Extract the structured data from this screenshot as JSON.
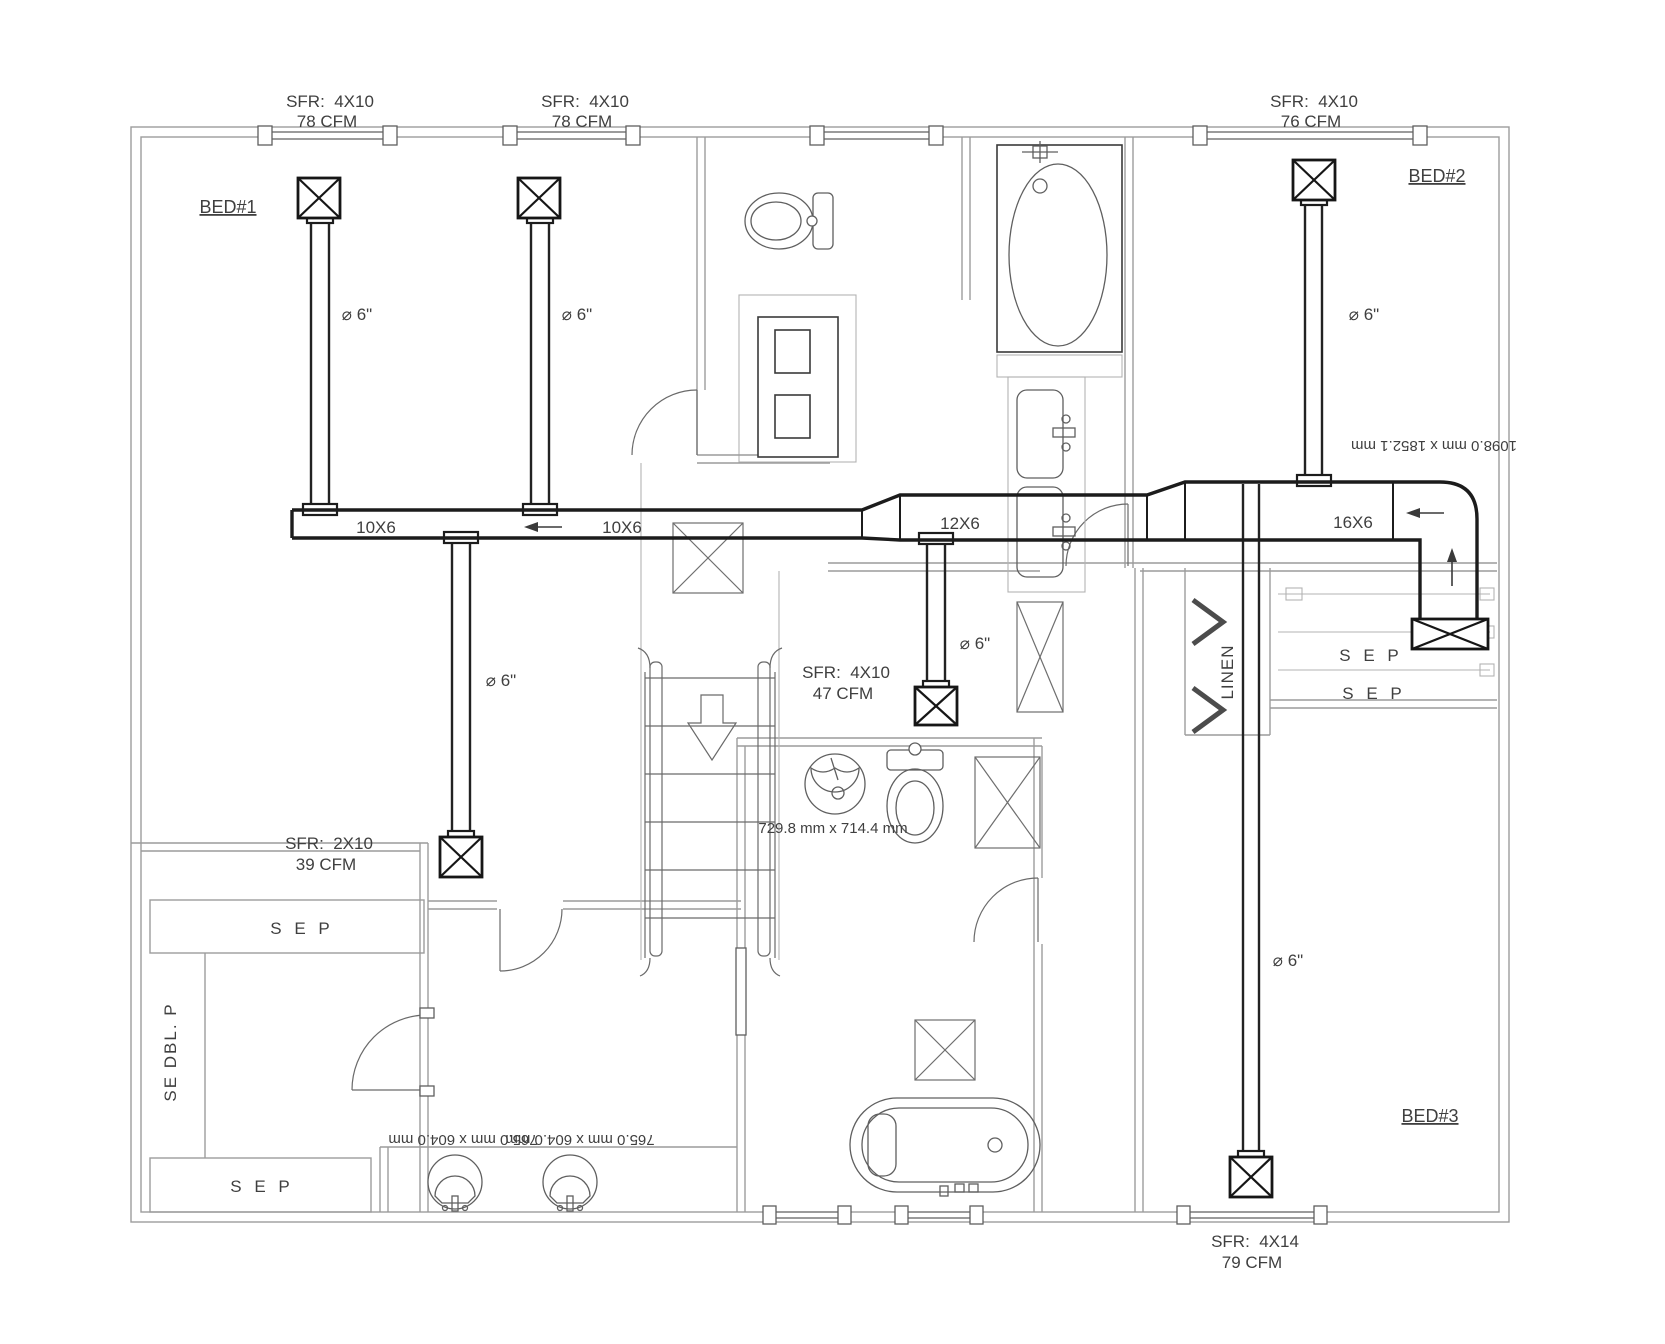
{
  "drawing_type": "hvac-duct-floor-plan",
  "colors": {
    "walls": "#9c9c9c",
    "ducts": "#1c1c1c",
    "fixtures": "#5f5f5f",
    "text": "#3f3f3f"
  },
  "rooms": {
    "bed1": "BED#1",
    "bed2": "BED#2",
    "bed3": "BED#3"
  },
  "supply_registers": [
    {
      "size": "SFR:  4X10",
      "cfm": "78 CFM"
    },
    {
      "size": "SFR:  4X10",
      "cfm": "78 CFM"
    },
    {
      "size": "SFR:  4X10",
      "cfm": "76 CFM"
    },
    {
      "size": "SFR:  4X10",
      "cfm": "47 CFM"
    },
    {
      "size": "SFR:  2X10",
      "cfm": "39 CFM"
    },
    {
      "size": "SFR:  4X14",
      "cfm": "79 CFM"
    }
  ],
  "duct_sections": [
    "10X6",
    "10X6",
    "12X6",
    "16X6"
  ],
  "branch_diameters": [
    "⌀ 6\"",
    "⌀ 6\"",
    "⌀ 6\"",
    "⌀ 6\"",
    "⌀ 6\"",
    "⌀ 6\""
  ],
  "closets": {
    "hall_shelf_1": "S E P",
    "hall_shelf_2": "S E P",
    "left_shelf_top": "S E P",
    "left_shelf_bottom": "S E P",
    "double_pole": "SE DBL. P",
    "linen": "LINEN"
  },
  "dimensions": {
    "master_tub": "1098.0 mm x 1852.1 mm",
    "powder_room": "729.8 mm x 714.4 mm",
    "vanity_sink_1": "765.0 mm x 604.0 mm",
    "vanity_sink_2": "765.0 mm x 604.0 mm"
  }
}
